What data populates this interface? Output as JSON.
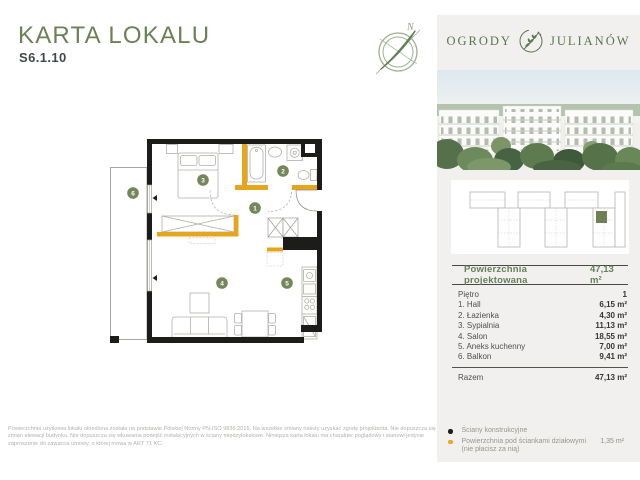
{
  "header": {
    "title": "KARTA LOKALU",
    "unit_id": "S6.1.10"
  },
  "compass": {
    "north_label": "N"
  },
  "floor_plan": {
    "room_numbers": [
      "1",
      "2",
      "3",
      "4",
      "5",
      "6"
    ]
  },
  "brand": {
    "name_left": "OGRODY",
    "name_right": "JULIANÓW"
  },
  "summary": {
    "label": "Powierzchnia projektowana",
    "value": "47,13 m²"
  },
  "table": {
    "floor_label": "Piętro",
    "floor_value": "1",
    "rooms": [
      {
        "label": "1. Hall",
        "value": "6,15 m²"
      },
      {
        "label": "2. Łazienka",
        "value": "4,30 m²"
      },
      {
        "label": "3. Sypialnia",
        "value": "11,13 m²"
      },
      {
        "label": "4. Salon",
        "value": "18,55 m²"
      },
      {
        "label": "5. Aneks kuchenny",
        "value": "7,00 m²"
      },
      {
        "label": "6. Balkon",
        "value": "9,41 m²"
      }
    ],
    "total_label": "Razem",
    "total_value": "47,13 m²"
  },
  "legend": {
    "structural": {
      "label": "Ściany konstrukcyjne"
    },
    "partition": {
      "label": "Powierzchnia pod ściankami działowymi",
      "label2": "(nie płacisz za nią)",
      "value": "1,35 m²"
    }
  },
  "disclaimer": {
    "line1": "Powierzchnia użytkowa lokalu określona została na podstawie Polskiej Normy PN-ISO 9836:2015. Na wszelkie zmiany należy uzyskać zgodę projektanta. Nie dopuszcza się",
    "line2": "zmian elewacji budynku. Nie dopuszcza się wkuwania podejść instalacyjnych w ściany międzylokalowe. Niniejsza karta lokalu ma charakter poglądowy i stanowi jedynie",
    "line3": "zaproszenie do zawarcia umowy, o której mowa w ART 71 KC."
  },
  "colors": {
    "accent_green": "#6d8157",
    "wall_black": "#1c1c1a",
    "partition_yellow": "#e7a41d",
    "legend_orange": "#efa51b",
    "panel_bg": "#f1f0ee",
    "highlight_unit_green": "#6f8153"
  }
}
